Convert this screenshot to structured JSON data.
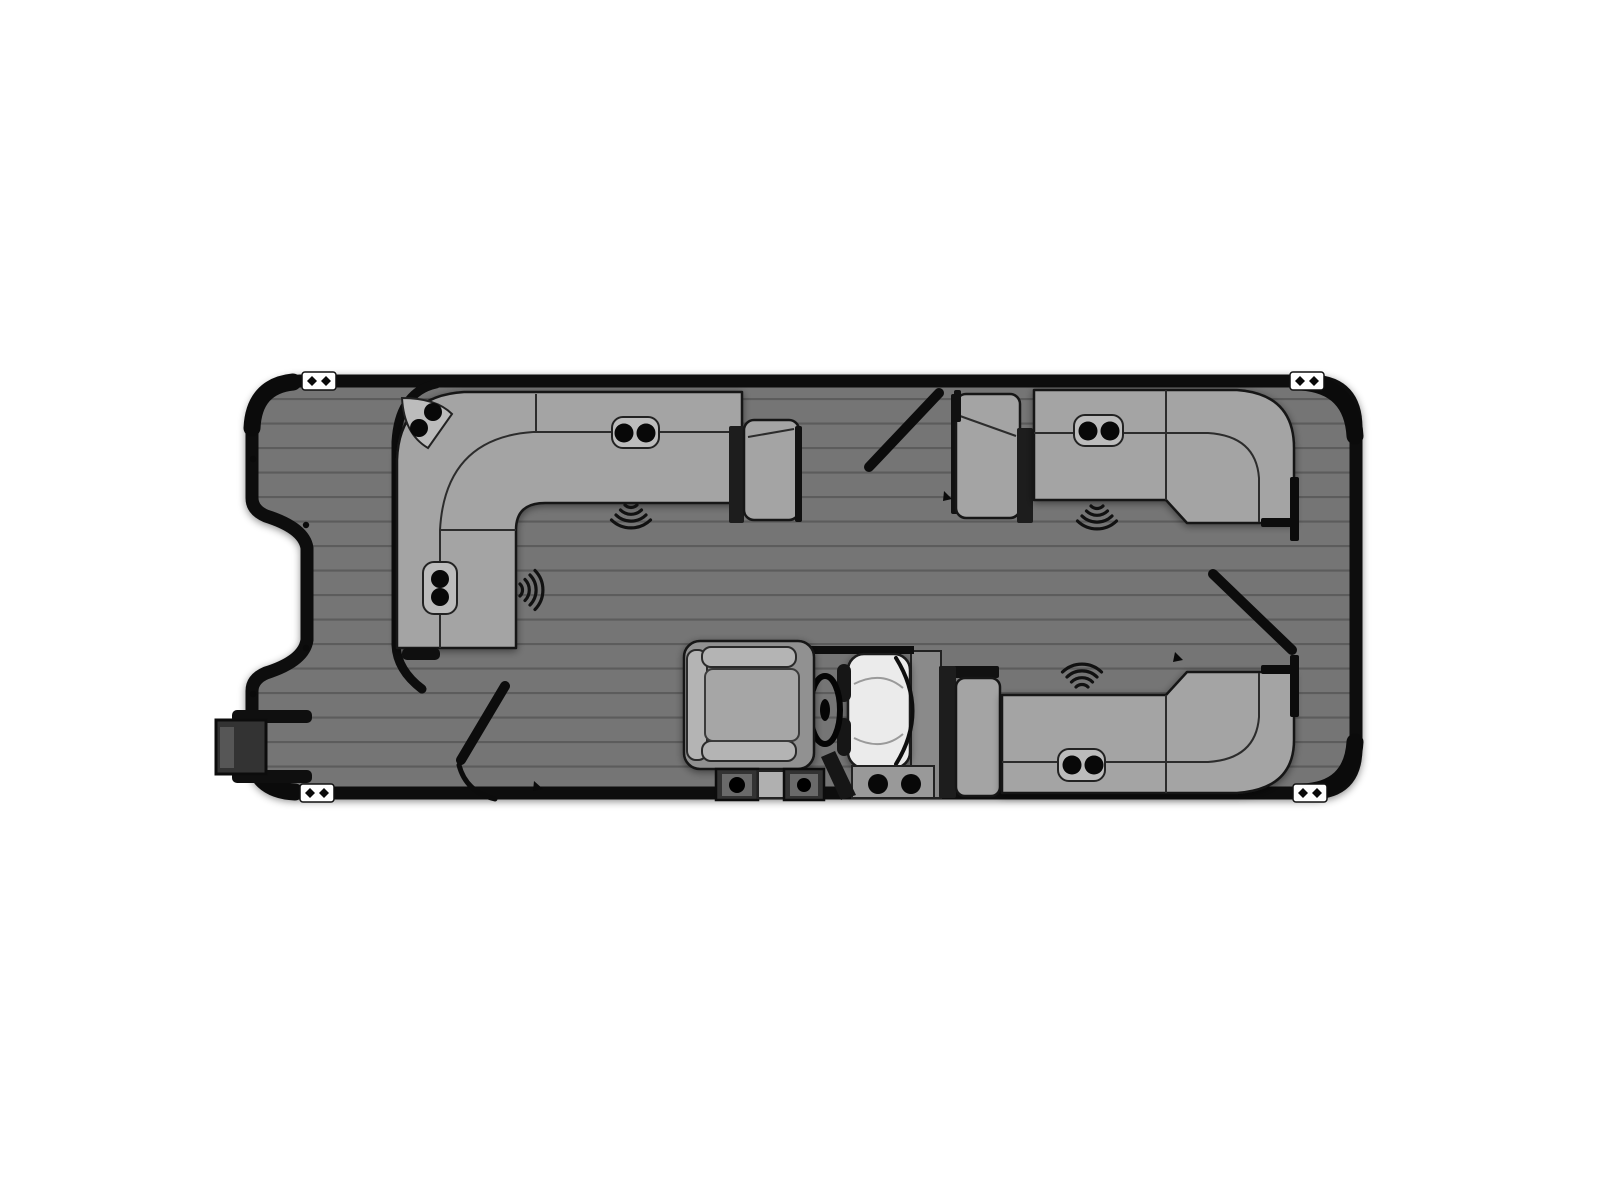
{
  "diagram": {
    "kind": "pontoon-boat-floorplan-top-view",
    "orientation": "bow-right",
    "counts": {
      "cleats": 4,
      "speakers": 4,
      "cupholder_pods": 6,
      "cupholders": 14,
      "gates": 3
    },
    "areas": [
      "aft-swim-deck",
      "stern-ladder",
      "aft-port-l-lounge",
      "helm-station",
      "bow-port-lounge",
      "bow-starboard-lounge",
      "bow-deck"
    ],
    "helm_items": [
      "captains-chair",
      "steering-wheel",
      "console",
      "windshield",
      "step-boxes"
    ]
  },
  "colors": {
    "page_bg": "#ffffff",
    "hull": "#0d0d0d",
    "deck": "#747474",
    "plank_line": "#5c5c5c",
    "couch": "#a4a4a4",
    "couch_outline": "#161616",
    "couch_line": "#2c2c2c",
    "divider": "#1d1d1d",
    "pod": "#bcbcbc",
    "cup": "#080808",
    "console": "#ebebeb",
    "console_line": "#9a9a9a",
    "chair_base": "#919191",
    "chair_trim": "#b4b4b4",
    "chair_seat": "#a6a6a6",
    "back_panel": "#8a8a8a",
    "platform": "#999999",
    "dark_box": "#333333",
    "dark_box_inner": "#6a6a6a",
    "cleat": "#ffffff",
    "speaker": "#111111"
  }
}
